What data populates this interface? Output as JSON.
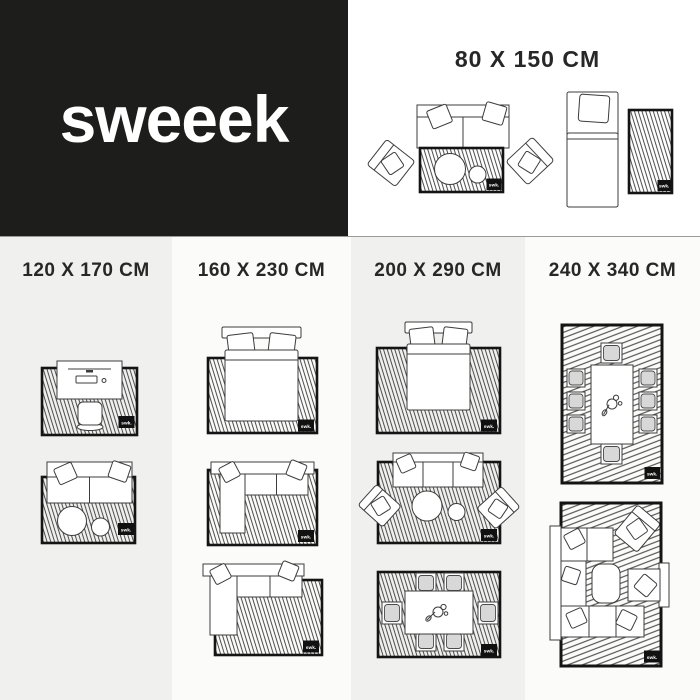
{
  "brand": {
    "logo": "sweeek"
  },
  "badge_label": "swk.",
  "hero": {
    "size_label": "80 X 150 CM",
    "diagrams": [
      "sofa-armchairs-coffee-tables-on-rug",
      "single-bed-with-bedside-rug"
    ]
  },
  "columns": [
    {
      "size_label": "120 X 170 CM",
      "diagrams": [
        "desk-with-chair-on-rug",
        "two-seat-sofa-with-tables-on-rug"
      ]
    },
    {
      "size_label": "160 X 230 CM",
      "diagrams": [
        "double-bed-on-rug",
        "corner-sofa-on-rug",
        "corner-sofa-partially-on-rug"
      ]
    },
    {
      "size_label": "200 X 290 CM",
      "diagrams": [
        "double-bed-on-large-rug",
        "sofa-two-armchairs-tables-on-rug",
        "dining-table-six-chairs-on-rug"
      ]
    },
    {
      "size_label": "240 X 340 CM",
      "diagrams": [
        "dining-table-eight-chairs-on-rug",
        "large-corner-sofa-set-on-rug"
      ]
    }
  ],
  "colors": {
    "brand_dark": "#1d1d1b",
    "panel_gray": "#f0f0ef",
    "panel_light": "#fbfbfa",
    "heading_text": "#272727",
    "divider_line": "#9a9a9a",
    "rug_border": "#141414",
    "chair_fill": "#d8d8d8"
  }
}
